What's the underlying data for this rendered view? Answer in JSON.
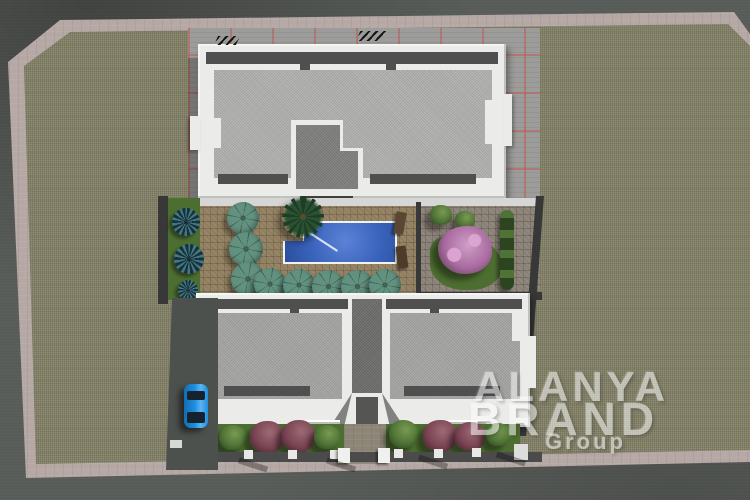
{
  "image": {
    "kind": "3d-architectural-site-plan-render",
    "description": "Aerial top-down 3D rendering of a residential complex: two white flat-roof apartment blocks, a central courtyard with swimming pool, teal sun umbrellas, gardens with shrubs and a pink flowering tree, parking apron with red stall lines, a blue parked car, surrounded by a khaki vacant lot, pink sidewalk and grey asphalt roads",
    "width_px": 750,
    "height_px": 500
  },
  "watermark": {
    "line1": "ALANYA",
    "line2": "BRAND",
    "line3": "Group",
    "color": "#ffffff"
  },
  "colors": {
    "road": "#585c58",
    "sidewalk": "#b5a8a5",
    "lot": "#8f8d74",
    "apron": "#9c9c9a",
    "parking_line": "#c05a50",
    "building_white": "#ebebe9",
    "parapet_shade": "#c9c9c7",
    "roof_gravel": "#b1b1af",
    "roof_gravel_dark": "#a5a5a3",
    "roof_core": "#7e7e7c",
    "walkway_dark": "#4f4f4f",
    "canopy_dark": "#3f3f3f",
    "pool_water": "#3a63bc",
    "pool_rim": "#f2f2f0",
    "deck": "#917e5f",
    "umbrella": "#63917f",
    "umbrella_rib": "#3f6b5c",
    "grass": "#4d6e31",
    "agave": "#2f4d55",
    "bush_green": "#5d7c3e",
    "bush_maroon": "#794353",
    "flower_tree": "#b078a8",
    "boundary_wall": "#383838",
    "driveway": "#4d514d",
    "car_blue": "#1d8fe0",
    "car_glass": "#16232e",
    "watermark": "#ffffff"
  },
  "scene": {
    "buildings": [
      {
        "name": "block-a-top",
        "roof": "grey gravel flat roof with white parapet and central stair core"
      },
      {
        "name": "block-b-bottom",
        "roof": "two mirrored wings with central dark stair core"
      }
    ],
    "pool": {
      "shape": "L-shaped rectangle with diagonal step ledge",
      "water_color": "#3a63bc"
    },
    "umbrella_count": 8,
    "front_shrub_count": 8,
    "agave_count": 3,
    "flowering_tree_count": 1,
    "palm_count": 1,
    "cars": [
      {
        "color": "#1d8fe0",
        "position": "west driveway beside bottom block"
      }
    ],
    "ground": {
      "lot": "khaki gravel vacant lot",
      "border": "pink sidewalk strip",
      "outer": "grey asphalt road"
    }
  }
}
